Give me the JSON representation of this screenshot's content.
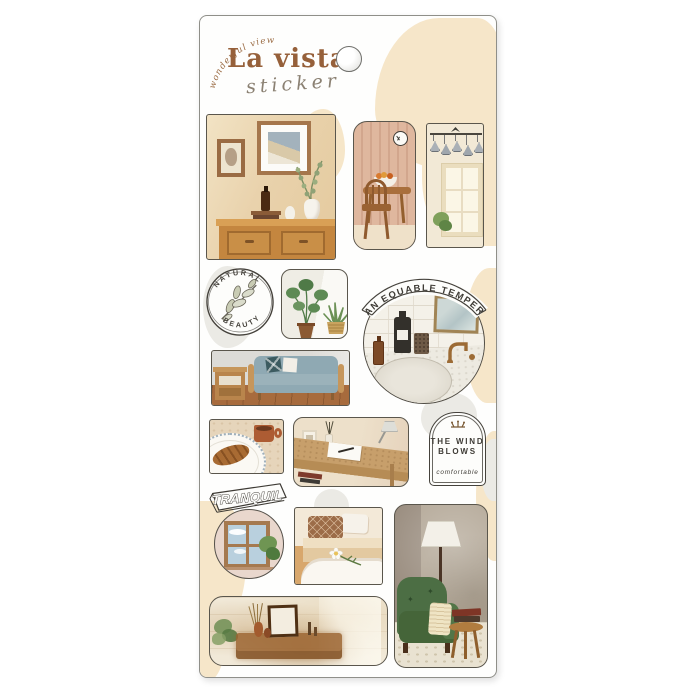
{
  "product": {
    "tagline": "wonderful view",
    "title": "La vista",
    "subtitle": "sticker"
  },
  "badges": {
    "natural_top": "NATURAL",
    "natural_bottom": "BEAUTY",
    "equable": "AN EQUABLE TEMPER",
    "wind_line1": "THE WIND",
    "wind_line2": "BLOWS",
    "wind_caption": "comfortable",
    "tranquil": "TRANQUIL"
  },
  "colors": {
    "accent_brown": "#96603A",
    "blob_beige": "#F6E6C9",
    "blob_grey": "#EBEAE5",
    "sticker_outline": "#5A564C"
  }
}
